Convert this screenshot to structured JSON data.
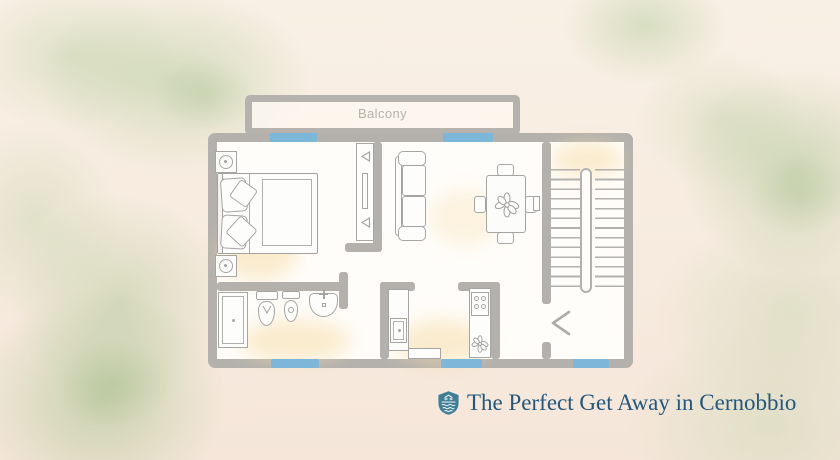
{
  "canvas": {
    "width": 840,
    "height": 460
  },
  "palette": {
    "background_cream": "#f7ebdf",
    "watercolor_green": "#a0c188",
    "wall_gray": "#b4b1ad",
    "furniture_line_gray": "#a7a5a2",
    "floor_white": "#fffdf9",
    "window_blue": "#7cb6d9",
    "floor_glow": "#f6ddaa",
    "caption_blue": "#23577d",
    "crest_teal": "#3e7e96",
    "balcony_label_gray": "#b7b1a7"
  },
  "floor_plan": {
    "balcony": {
      "label": "Balcony"
    },
    "areas": [
      "balcony",
      "bedroom",
      "living-dining-room",
      "bathroom",
      "kitchen",
      "stair-hall"
    ],
    "window_count": 5,
    "furniture_icons": [
      "nightstand-lamp-icon",
      "double-bed-icon",
      "media-unit-icon",
      "sofa-icon",
      "dining-table-icon",
      "dining-chair-icon",
      "table-plant-icon",
      "staircase-icon",
      "light-switch-icon",
      "door-swing-icon",
      "shower-icon",
      "bidet-icon",
      "toilet-icon",
      "washbasin-icon",
      "kitchen-sink-counter-icon",
      "stove-counter-icon",
      "counter-plant-icon"
    ]
  },
  "caption": {
    "icon": "shield-crest-icon",
    "text": "The Perfect Get Away in Cernobbio"
  }
}
